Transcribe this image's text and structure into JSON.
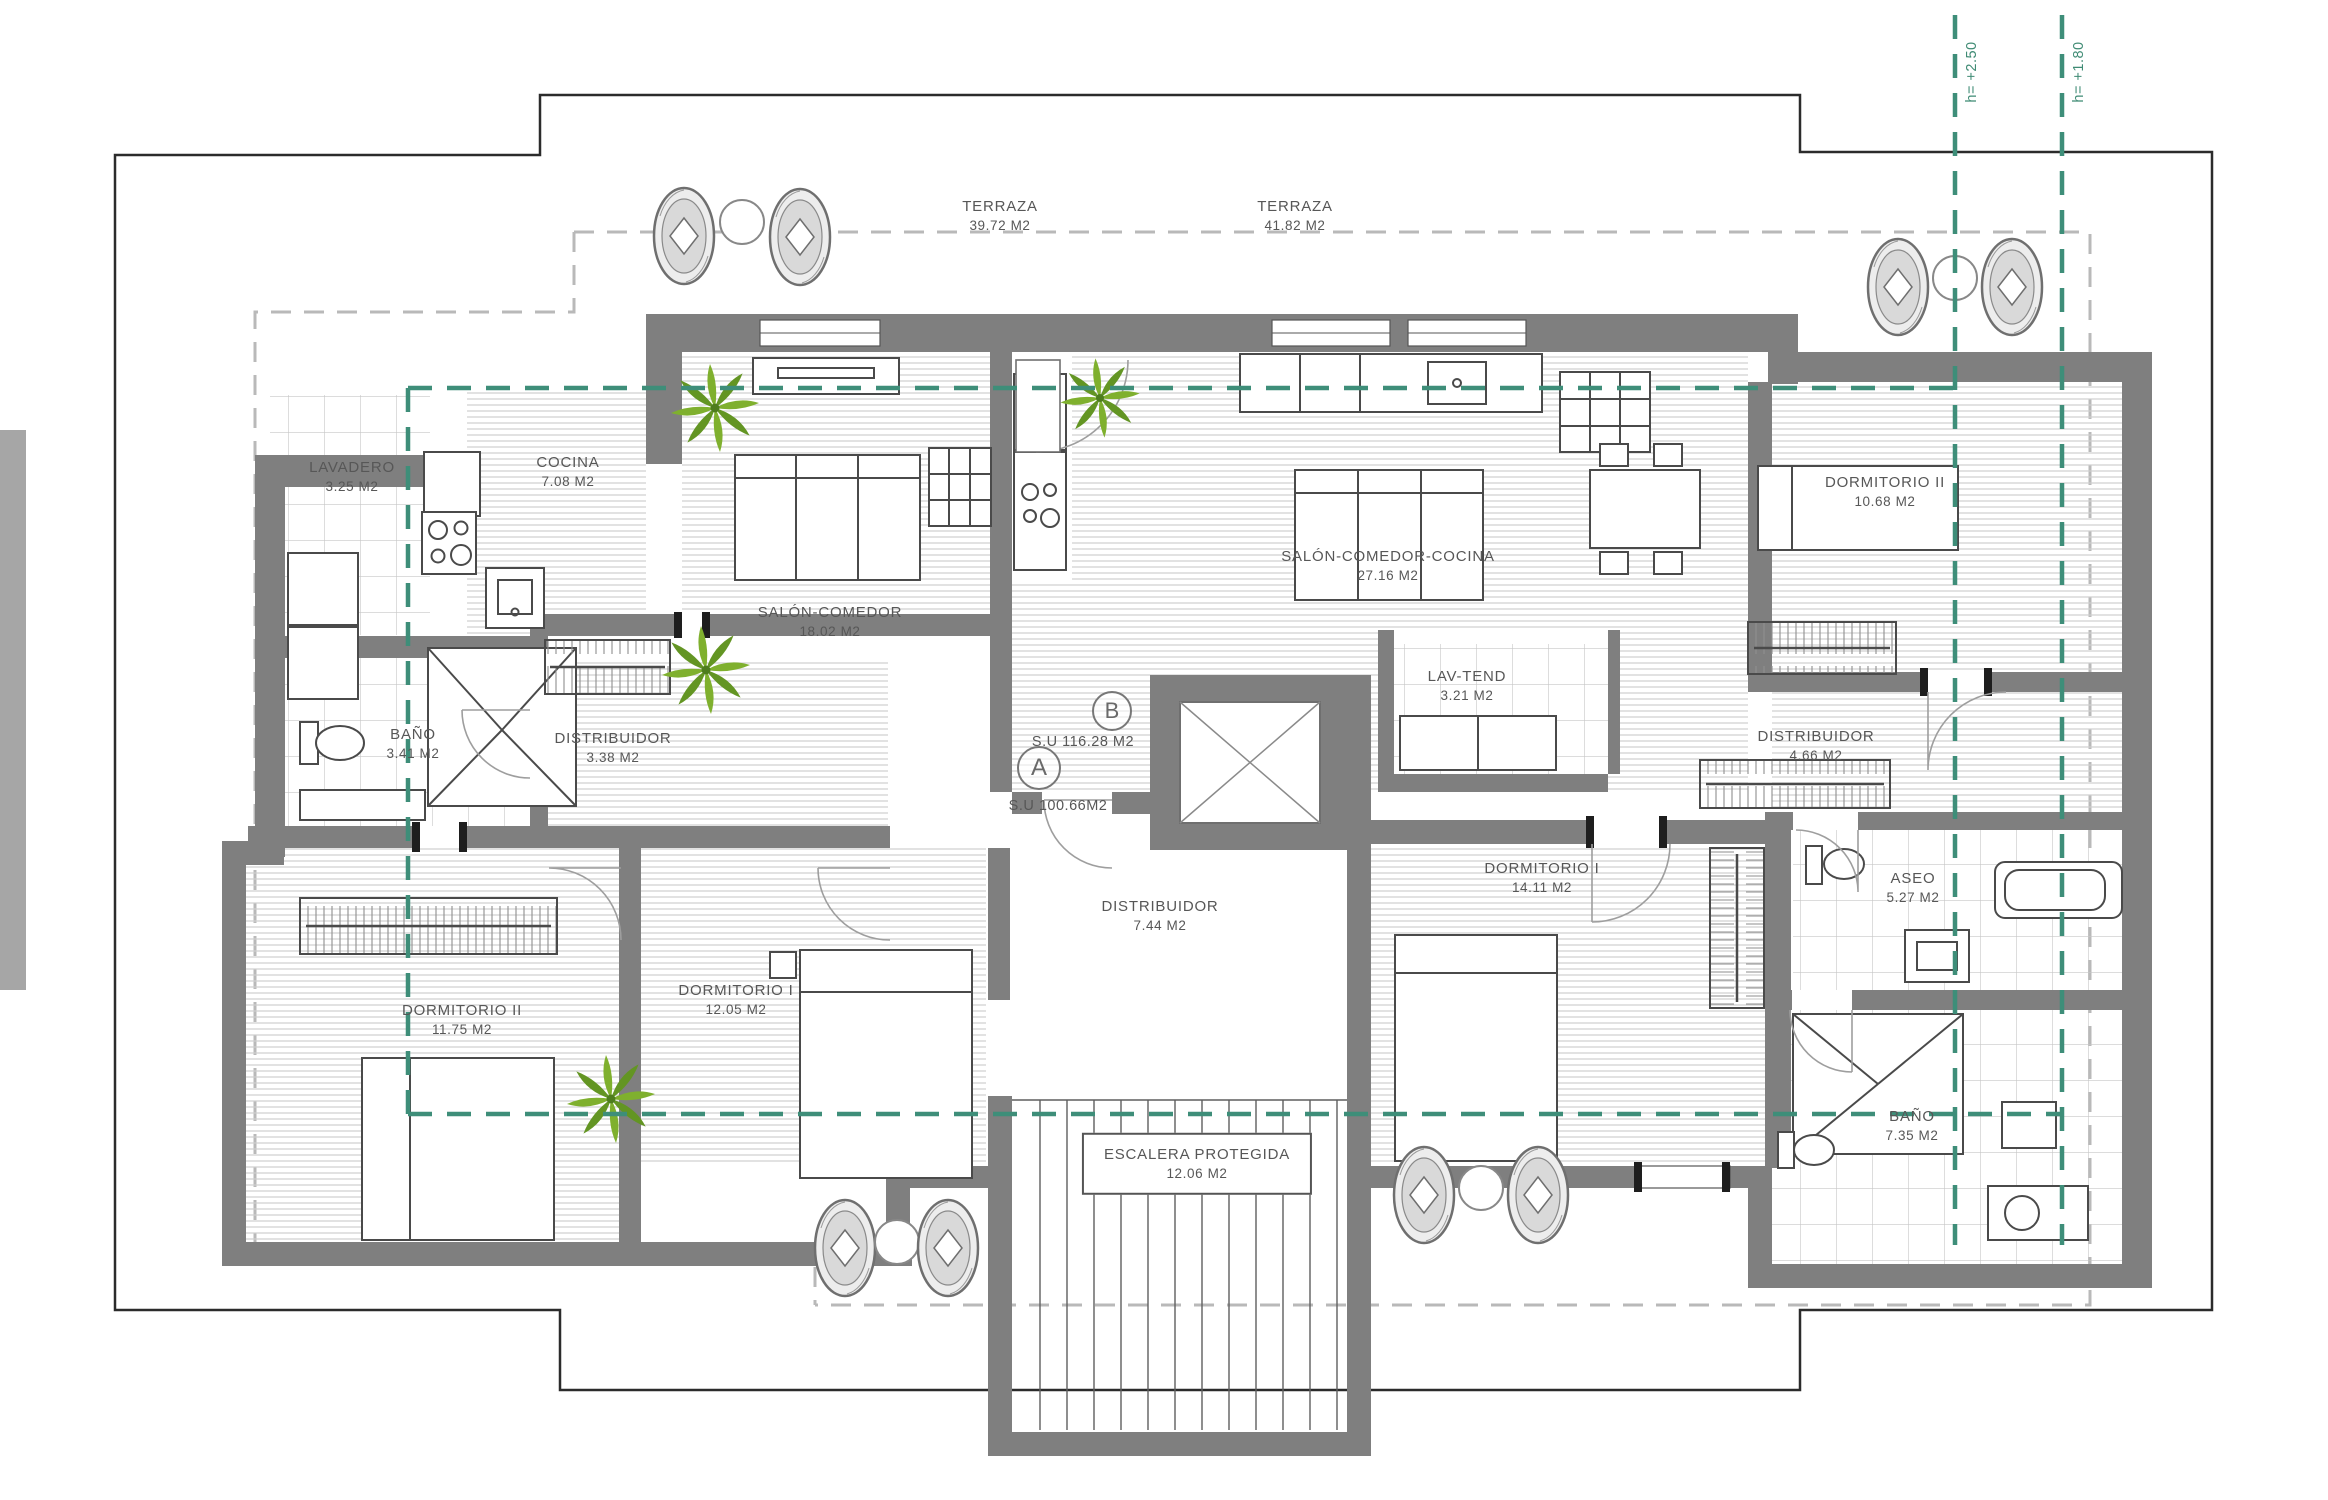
{
  "plan": {
    "units": {
      "a": {
        "letter": "A",
        "surface": "S.U 100.66M2"
      },
      "b": {
        "letter": "B",
        "surface": "S.U 116.28 M2"
      }
    },
    "terraces": [
      {
        "name": "TERRAZA",
        "area": "39.72 M2"
      },
      {
        "name": "TERRAZA",
        "area": "41.82 M2"
      }
    ],
    "rooms": [
      {
        "name": "LAVADERO",
        "area": "3.25 M2"
      },
      {
        "name": "COCINA",
        "area": "7.08 M2"
      },
      {
        "name": "SALÓN-COMEDOR",
        "area": "18.02 M2"
      },
      {
        "name": "BAÑO",
        "area": "3.41 M2"
      },
      {
        "name": "DISTRIBUIDOR",
        "area": "3.38 M2"
      },
      {
        "name": "DORMITORIO II",
        "area": "11.75 M2"
      },
      {
        "name": "DORMITORIO I",
        "area": "12.05 M2"
      },
      {
        "name": "DISTRIBUIDOR",
        "area": "7.44 M2"
      },
      {
        "name": "ESCALERA PROTEGIDA",
        "area": "12.06 M2"
      },
      {
        "name": "SALÓN-COMEDOR-COCINA",
        "area": "27.16 M2"
      },
      {
        "name": "LAV-TEND",
        "area": "3.21 M2"
      },
      {
        "name": "DORMITORIO II",
        "area": "10.68 M2"
      },
      {
        "name": "DISTRIBUIDOR",
        "area": "4.66 M2"
      },
      {
        "name": "DORMITORIO I",
        "area": "14.11 M2"
      },
      {
        "name": "ASEO",
        "area": "5.27 M2"
      },
      {
        "name": "BAÑO",
        "area": "7.35 M2"
      }
    ],
    "height_marks": [
      {
        "label": "h= +2.50"
      },
      {
        "label": "h= +1.80"
      }
    ],
    "colors": {
      "wall": "#7f7f7f",
      "hatch_line": "#cdcdcd",
      "tile_line": "#c6c6c6",
      "green_reference": "#3e8e79",
      "plant_green": "#7fb02e",
      "label_text": "#575757",
      "parcel_line": "#2b2b2b",
      "terrace_dash": "#b9b9b9"
    }
  }
}
